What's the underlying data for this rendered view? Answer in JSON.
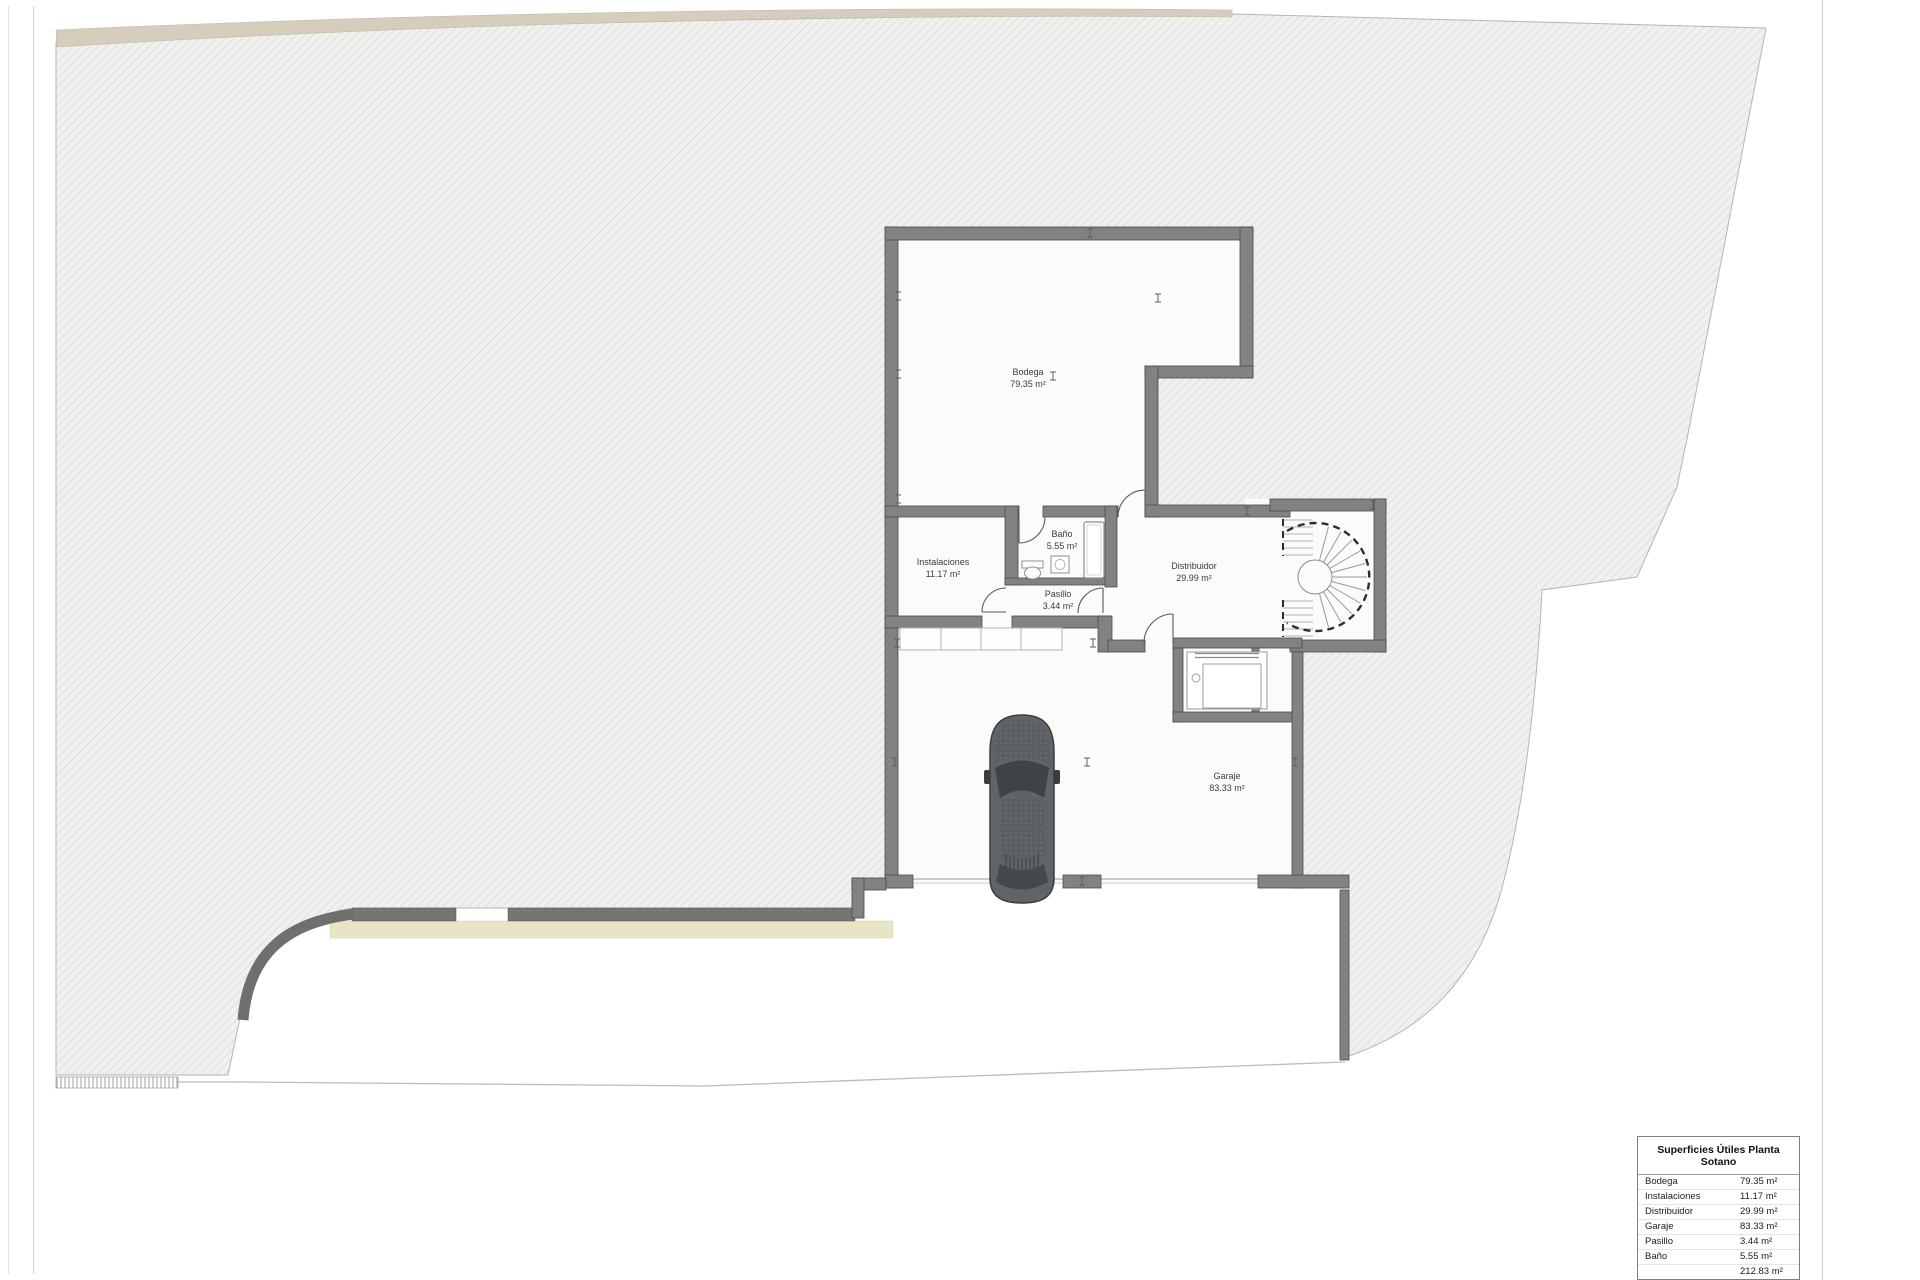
{
  "sheet": {
    "rooms": [
      {
        "name": "Bodega",
        "area": "79.35 m²"
      },
      {
        "name": "Instalaciones",
        "area": "11.17 m²"
      },
      {
        "name": "Baño",
        "area": "5.55 m²"
      },
      {
        "name": "Pasillo",
        "area": "3.44 m²"
      },
      {
        "name": "Distribuidor",
        "area": "29.99 m²"
      },
      {
        "name": "Garaje",
        "area": "83.33 m²"
      }
    ],
    "legend": {
      "title": "Superficies Útiles Planta Sotano",
      "rows": [
        {
          "label": "Bodega",
          "value": "79.35 m²"
        },
        {
          "label": "Instalaciones",
          "value": "11.17 m²"
        },
        {
          "label": "Distribuidor",
          "value": "29.99 m²"
        },
        {
          "label": "Garaje",
          "value": "83.33 m²"
        },
        {
          "label": "Pasillo",
          "value": "3.44 m²"
        },
        {
          "label": "Baño",
          "value": "5.55 m²"
        }
      ],
      "total": "212.83 m²"
    },
    "colors": {
      "hatch_line": "#d6d6d4",
      "wall_fill": "#828282",
      "soil_band": "#d6cebc",
      "planter_band": "#e8e5c6",
      "retaining_wall": "#757573"
    }
  }
}
